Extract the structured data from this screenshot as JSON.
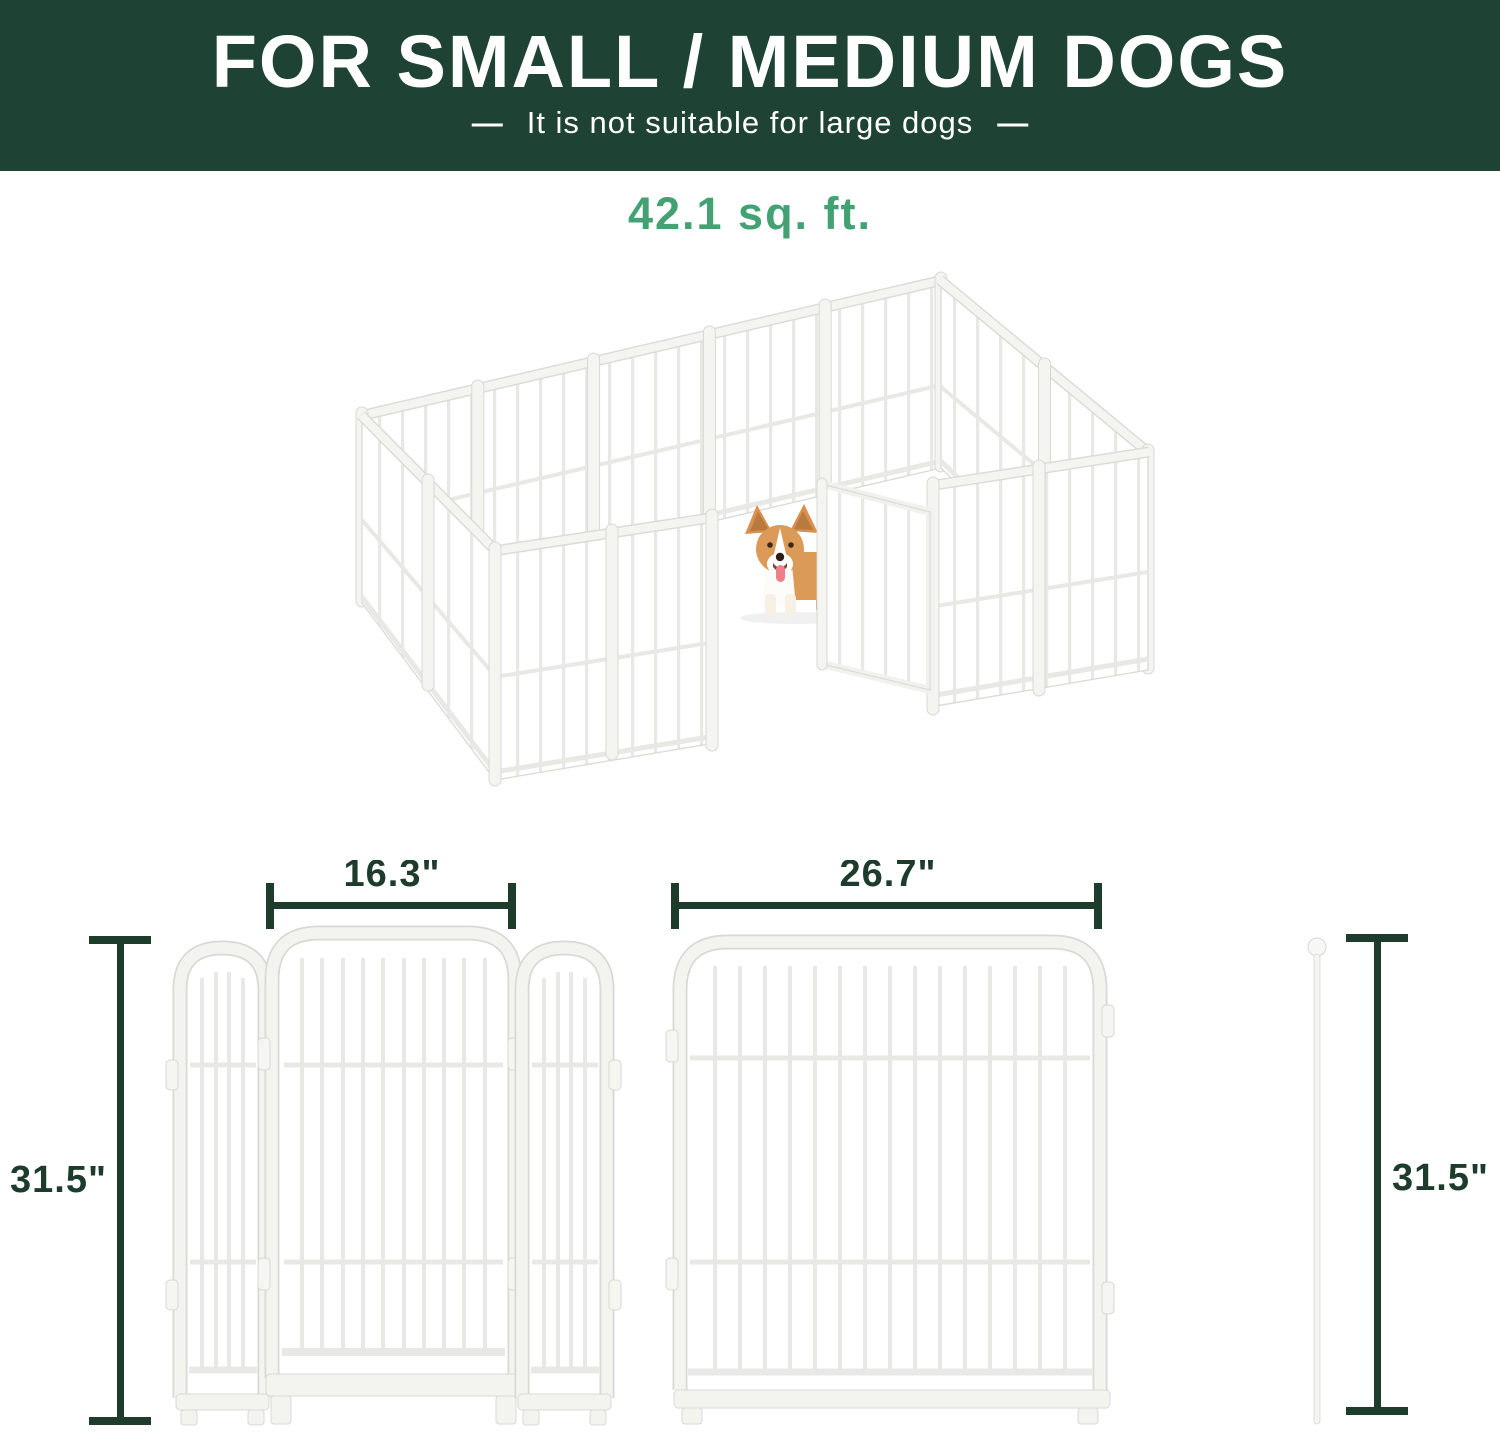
{
  "header": {
    "title": "FOR SMALL / MEDIUM DOGS",
    "dash": "—",
    "subtitle_text": "It is not suitable for large dogs"
  },
  "area": {
    "label": "42.1 sq. ft."
  },
  "diagram": {
    "gate_width_label": "16.3\"",
    "panel_width_label": "26.7\"",
    "left_height_label": "31.5\"",
    "right_height_label": "31.5\""
  },
  "colors": {
    "header_bg": "#1e4233",
    "accent_green": "#44a173",
    "dimension_green": "#1e3c2c",
    "pen_outline": "#dcdcd7",
    "corgi_tan": "#db9a57"
  },
  "icons": {
    "playpen": "dog-playpen-3d-figure",
    "dog": "corgi-dog",
    "rod": "connector-rod"
  }
}
